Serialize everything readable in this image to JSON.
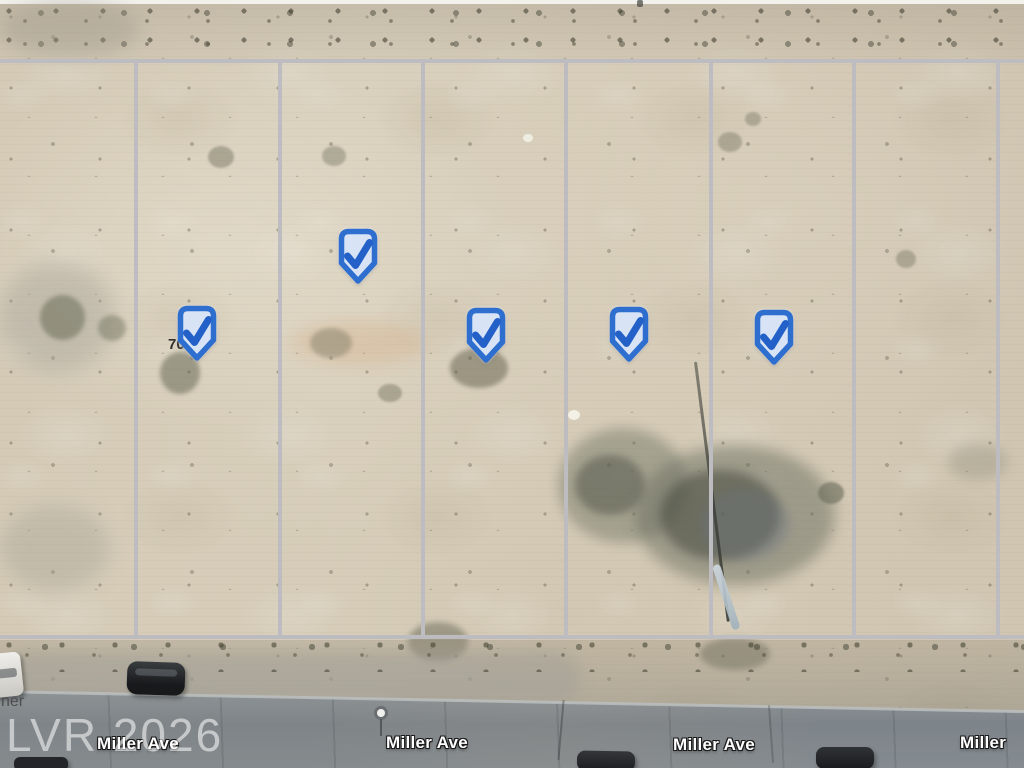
{
  "map": {
    "kind": "satellite-aerial-view",
    "watermark_text": "LVR 2026",
    "street_name": "Miller Ave",
    "street_labels": [
      {
        "text": "Miller Ave"
      },
      {
        "text": "Miller Ave"
      },
      {
        "text": "Miller Ave"
      },
      {
        "text": "Miller"
      }
    ],
    "street_label_partial_left": "ner",
    "parcel_number_partial": "70",
    "markers": {
      "icon": "check-shield-icon",
      "count": 5
    }
  },
  "theme": {
    "marker_border": "#2d6ecf",
    "marker_fill": "#d8e4f6",
    "marker_check": "#2361c9",
    "parcel_line": "#bdbdc1",
    "road_asphalt": "#878e94",
    "sand_base": "#d7cdb9",
    "road_label_color": "#ffffff",
    "watermark_color": "rgba(255,255,255,0.55)"
  }
}
